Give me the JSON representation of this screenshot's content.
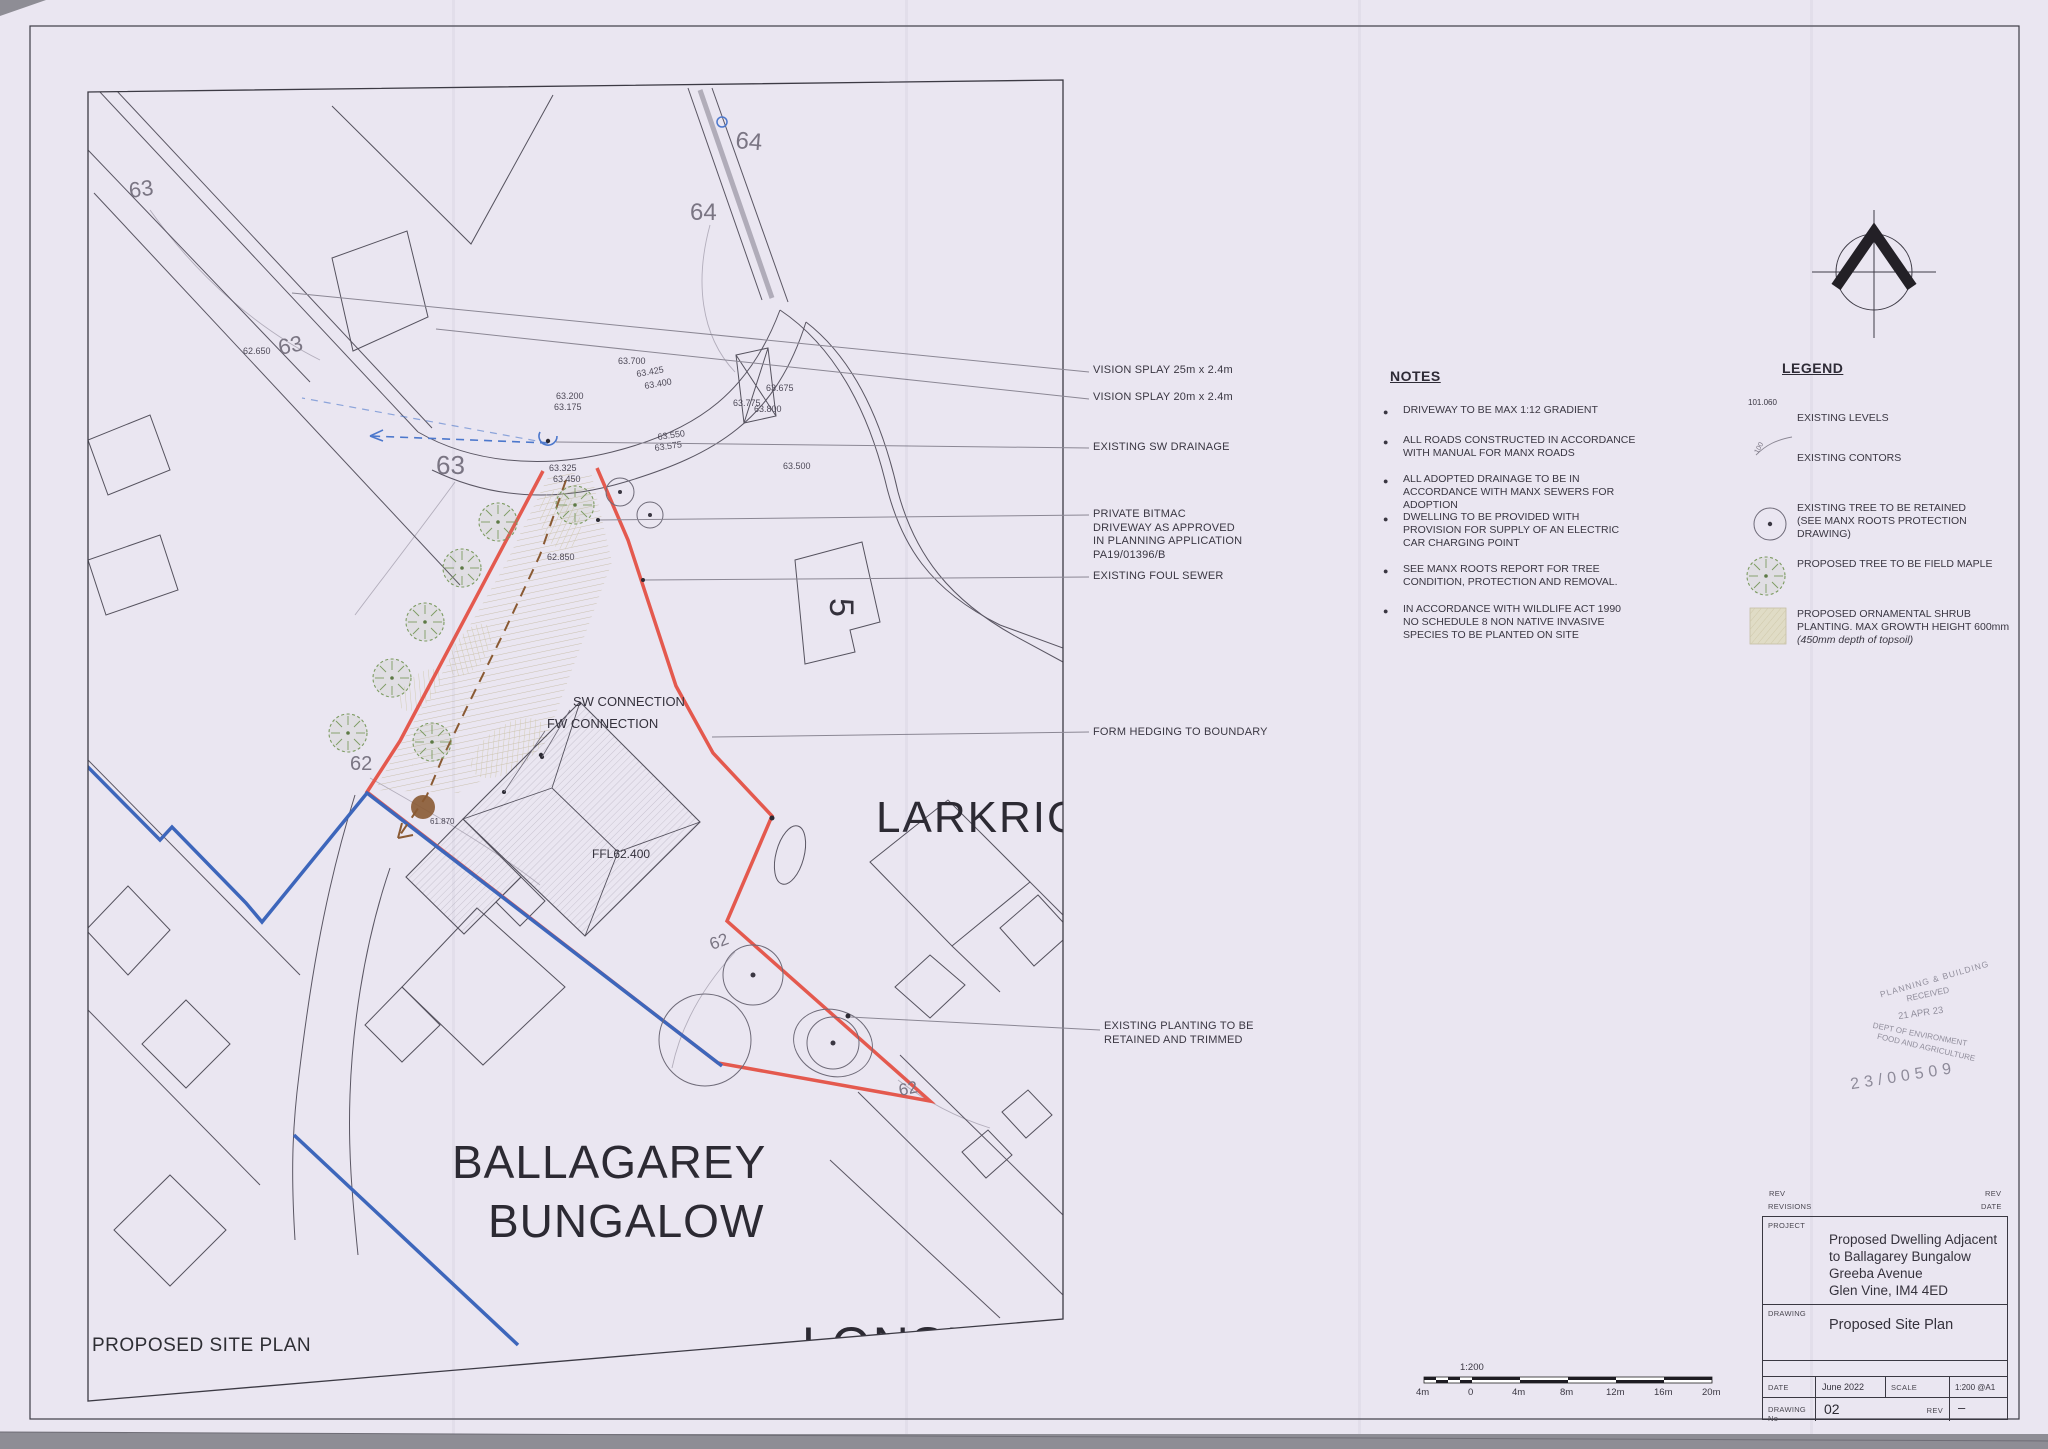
{
  "plan": {
    "title": "PROPOSED SITE PLAN",
    "labels": {
      "larkrigg": "LARKRIG",
      "ballagarey1": "BALLAGAREY",
      "ballagarey2": "BUNGALOW",
      "lonsdale": "LONSDALE",
      "house_number": "5",
      "sw": "SW CONNECTION",
      "fw": "FW CONNECTION",
      "ffl": "FFL62.400"
    },
    "contour_labels": [
      "63",
      "63",
      "63",
      "64",
      "64",
      "62",
      "62",
      "62"
    ],
    "spot_levels": [
      "62.650",
      "63.700",
      "63.425",
      "63.400",
      "63.200",
      "63.175",
      "63.675",
      "63.775",
      "63.800",
      "63.550",
      "63.575",
      "63.500",
      "63.325",
      "63.450",
      "62.850",
      "61.870"
    ]
  },
  "callouts": [
    {
      "label": "VISION SPLAY 25m x 2.4m"
    },
    {
      "label": "VISION SPLAY 20m x 2.4m"
    },
    {
      "label": "EXISTING SW DRAINAGE"
    },
    {
      "label": "PRIVATE BITMAC DRIVEWAY AS APPROVED IN PLANNING APPLICATION PA19/01396/B"
    },
    {
      "label": "EXISTING FOUL SEWER"
    },
    {
      "label": "FORM HEDGING TO BOUNDARY"
    },
    {
      "label": "EXISTING PLANTING TO BE RETAINED AND TRIMMED"
    }
  ],
  "notes": {
    "title": "NOTES",
    "items": [
      "DRIVEWAY TO BE MAX 1:12 GRADIENT",
      "ALL ROADS CONSTRUCTED IN ACCORDANCE WITH MANUAL FOR MANX ROADS",
      "ALL ADOPTED DRAINAGE TO BE IN ACCORDANCE WITH MANX SEWERS FOR ADOPTION",
      "DWELLING TO BE PROVIDED WITH PROVISION FOR SUPPLY OF AN ELECTRIC CAR CHARGING POINT",
      "SEE MANX ROOTS REPORT FOR TREE CONDITION, PROTECTION AND REMOVAL.",
      "IN ACCORDANCE WITH WILDLIFE ACT 1990 NO SCHEDULE 8 NON NATIVE INVASIVE SPECIES TO BE PLANTED ON SITE"
    ]
  },
  "legend": {
    "title": "LEGEND",
    "sample_level": "101.060",
    "sample_contour": "100",
    "items": [
      "EXISTING LEVELS",
      "EXISTING CONTORS",
      "EXISTING TREE TO BE RETAINED (SEE MANX ROOTS PROTECTION DRAWING)",
      "PROPOSED TREE TO BE FIELD MAPLE",
      "PROPOSED ORNAMENTAL SHRUB PLANTING. MAX GROWTH HEIGHT 600mm",
      "(450mm depth of topsoil)"
    ]
  },
  "stamp": {
    "lines": [
      "PLANNING & BUILDING",
      "RECEIVED",
      "21 APR 23",
      "DEPT OF ENVIRONMENT",
      "FOOD AND AGRICULTURE"
    ],
    "application_number": "23/00509"
  },
  "title_block": {
    "rev_label": "REV",
    "revisions_label": "REVISIONS",
    "rev_right_label": "REV",
    "date_right_label": "DATE",
    "project_label": "PROJECT",
    "project_lines": [
      "Proposed Dwelling Adjacent",
      "to Ballagarey Bungalow",
      "Greeba Avenue",
      "Glen Vine, IM4 4ED"
    ],
    "drawing_label": "DRAWING",
    "drawing_name": "Proposed Site Plan",
    "date_label": "DATE",
    "date_value": "June 2022",
    "scale_label": "SCALE",
    "scale_value": "1:200 @A1",
    "drawing_no_label": "DRAWING No",
    "drawing_no_value": "02",
    "rev_cell_label": "REV",
    "rev_value": "–"
  },
  "scale_bar": {
    "ratio": "1:200",
    "ticks": [
      "4m",
      "0",
      "4m",
      "8m",
      "12m",
      "16m",
      "20m"
    ]
  }
}
